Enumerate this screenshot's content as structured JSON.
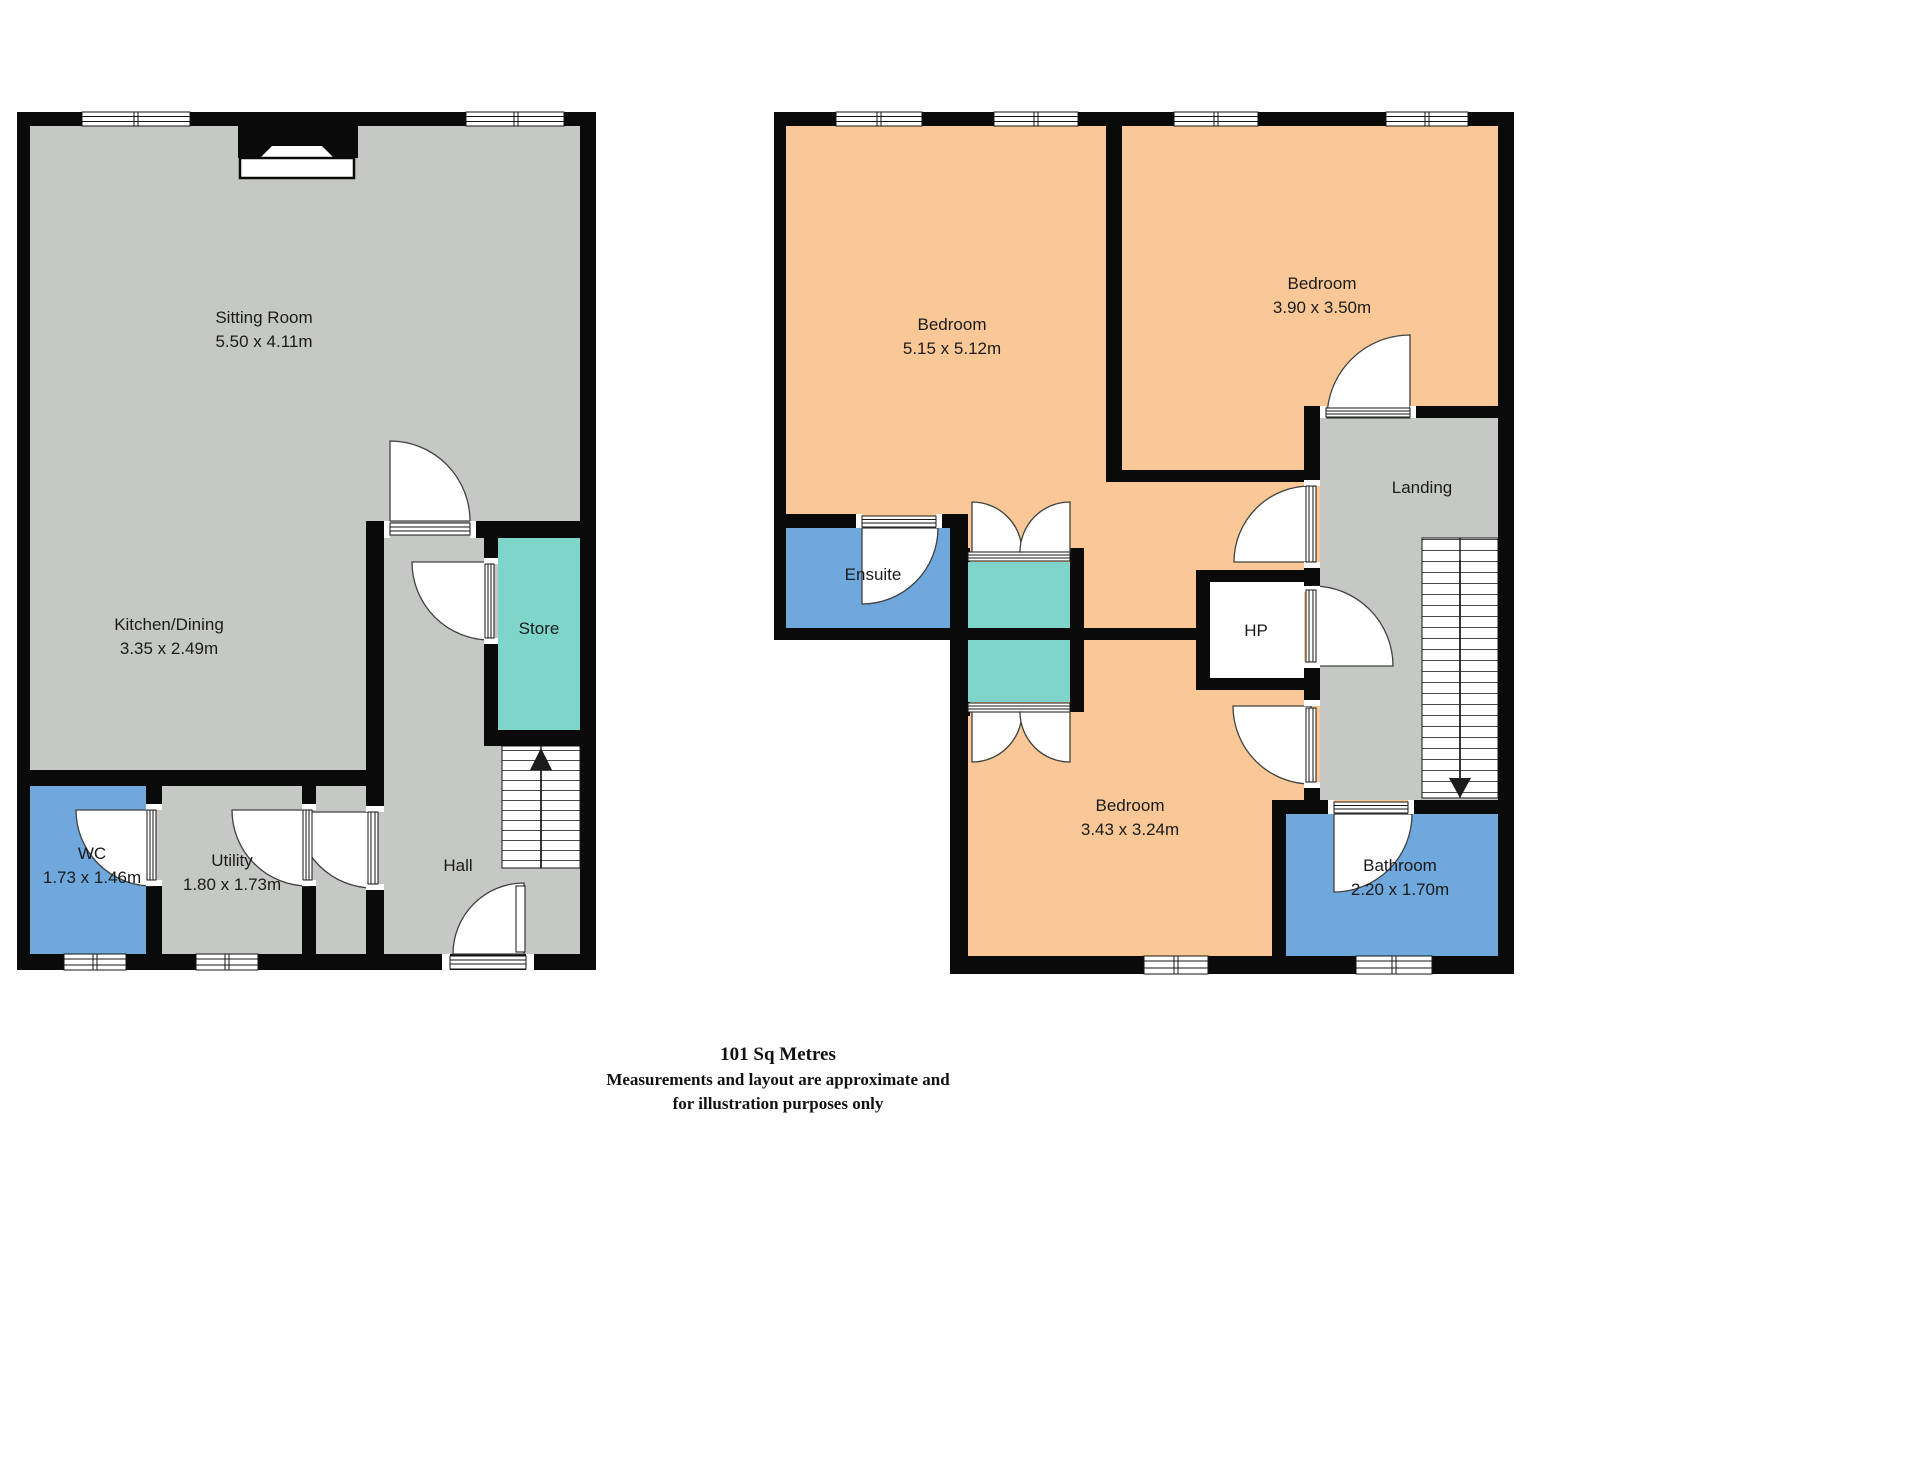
{
  "colors": {
    "bg": "#ffffff",
    "wall": "#0a0a0a",
    "floor-gray": "#c6c8c5",
    "room-blue": "#6fa8dc",
    "room-teal": "#7ed5c9",
    "room-peach": "#f9c896",
    "text": "#1b1b1b"
  },
  "floors": {
    "ground": {
      "rooms": {
        "sitting": {
          "name": "Sitting Room",
          "dims": "5.50 x 4.11m"
        },
        "kitchen": {
          "name": "Kitchen/Dining",
          "dims": "3.35 x 2.49m"
        },
        "store": {
          "name": "Store"
        },
        "wc": {
          "name": "WC",
          "dims": "1.73 x 1.46m"
        },
        "utility": {
          "name": "Utility",
          "dims": "1.80 x 1.73m"
        },
        "hall": {
          "name": "Hall"
        }
      }
    },
    "first": {
      "rooms": {
        "bedroom1": {
          "name": "Bedroom",
          "dims": "5.15 x 5.12m"
        },
        "bedroom2": {
          "name": "Bedroom",
          "dims": "3.90 x 3.50m"
        },
        "bedroom3": {
          "name": "Bedroom",
          "dims": "3.43 x 3.24m"
        },
        "ensuite": {
          "name": "Ensuite"
        },
        "landing": {
          "name": "Landing"
        },
        "hp": {
          "name": "HP"
        },
        "bathroom": {
          "name": "Bathroom",
          "dims": "2.20 x 1.70m"
        }
      }
    }
  },
  "footer": {
    "area": "101 Sq Metres",
    "disclaimer1": "Measurements and layout are approximate and",
    "disclaimer2": "for illustration purposes only"
  }
}
